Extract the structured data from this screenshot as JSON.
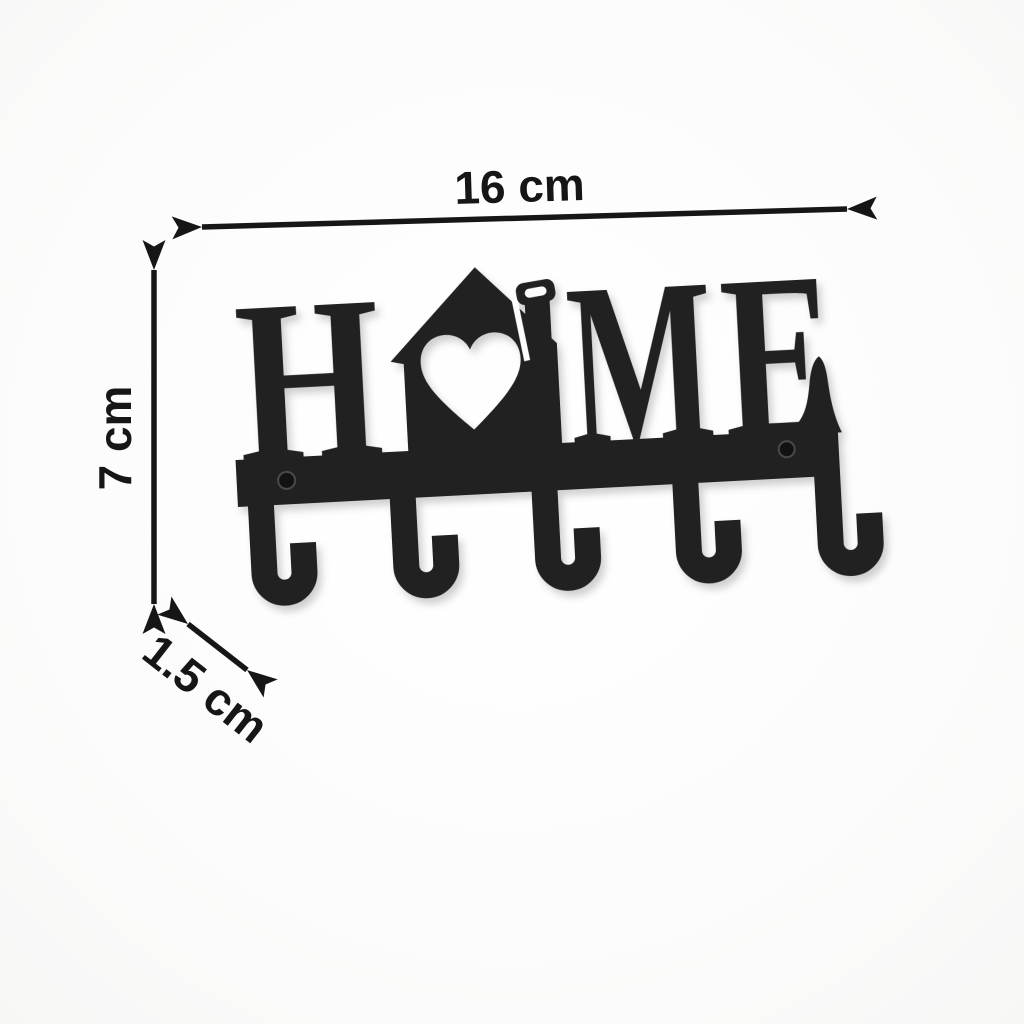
{
  "product": {
    "word": "HOME",
    "letters": [
      "H",
      "M",
      "E"
    ],
    "o_replacement": "house-with-heart-and-chimney-ring",
    "hook_count": 5,
    "screw_hole_count": 2
  },
  "dimensions": {
    "width": "16 cm",
    "height": "7 cm",
    "depth": "1.5 cm"
  },
  "colors": {
    "background": "#fcfcfc",
    "object": "#212121",
    "annotation": "#161616"
  }
}
